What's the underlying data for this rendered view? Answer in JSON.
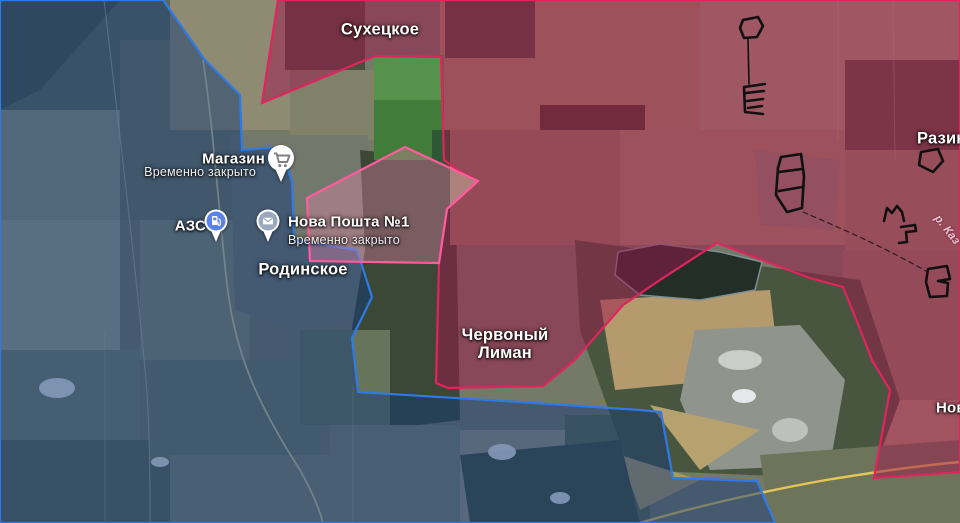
{
  "map": {
    "towns": {
      "sukhetskoe": "Сухецкое",
      "razino": "Разино",
      "chervony_liman": "Червоный Лиман",
      "rodinskoe": "Родинское",
      "novo_clipped": "Ново"
    },
    "river_label": "р. Каз",
    "pois": {
      "shop": {
        "name": "Магазин",
        "status": "Временно закрыто",
        "icon": "shopping-cart-icon"
      },
      "gas": {
        "name": "АЗС",
        "status": "",
        "icon": "fuel-pump-icon"
      },
      "post": {
        "name": "Нова Пошта №1",
        "status": "Временно закрыто",
        "icon": "mail-icon"
      }
    },
    "zones": {
      "friendly_border": "#2f7ae5",
      "occupied_border": "#e0245e",
      "advance_border": "#ff5c9e",
      "fortification_color": "#101010"
    }
  }
}
